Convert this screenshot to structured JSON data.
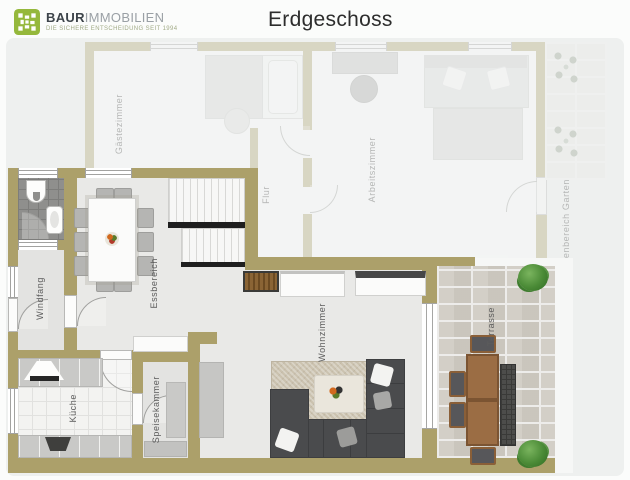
{
  "header": {
    "brand": {
      "name_bold": "BAUR",
      "name_light": "IMMOBILIEN",
      "tagline": "DIE SICHERE ENTSCHEIDUNG SEIT 1994"
    },
    "title": "Erdgeschoss"
  },
  "rooms": {
    "windfang": "Windfang",
    "essbereich": "Essbereich",
    "kueche": "Küche",
    "speisekammer": "Speisekammer",
    "wohnzimmer": "Wohnzimmer",
    "terrasse": "Terrasse",
    "gaestezimmer": "Gästezimmer",
    "flur": "Flur",
    "arbeitszimmer": "Arbeitszimmer",
    "aussenbereich_garten": "Außenbereich Garten"
  },
  "colors": {
    "wall": "#aca06a",
    "floor": "#e9e9e7",
    "logo_green": "#95b83c",
    "sofa": "#4a4b4d",
    "rug": "#cbc2af",
    "terrace_stone": "#d3cfc7",
    "bush_green": "#4a8a36",
    "page_card": "#eef0ef"
  }
}
